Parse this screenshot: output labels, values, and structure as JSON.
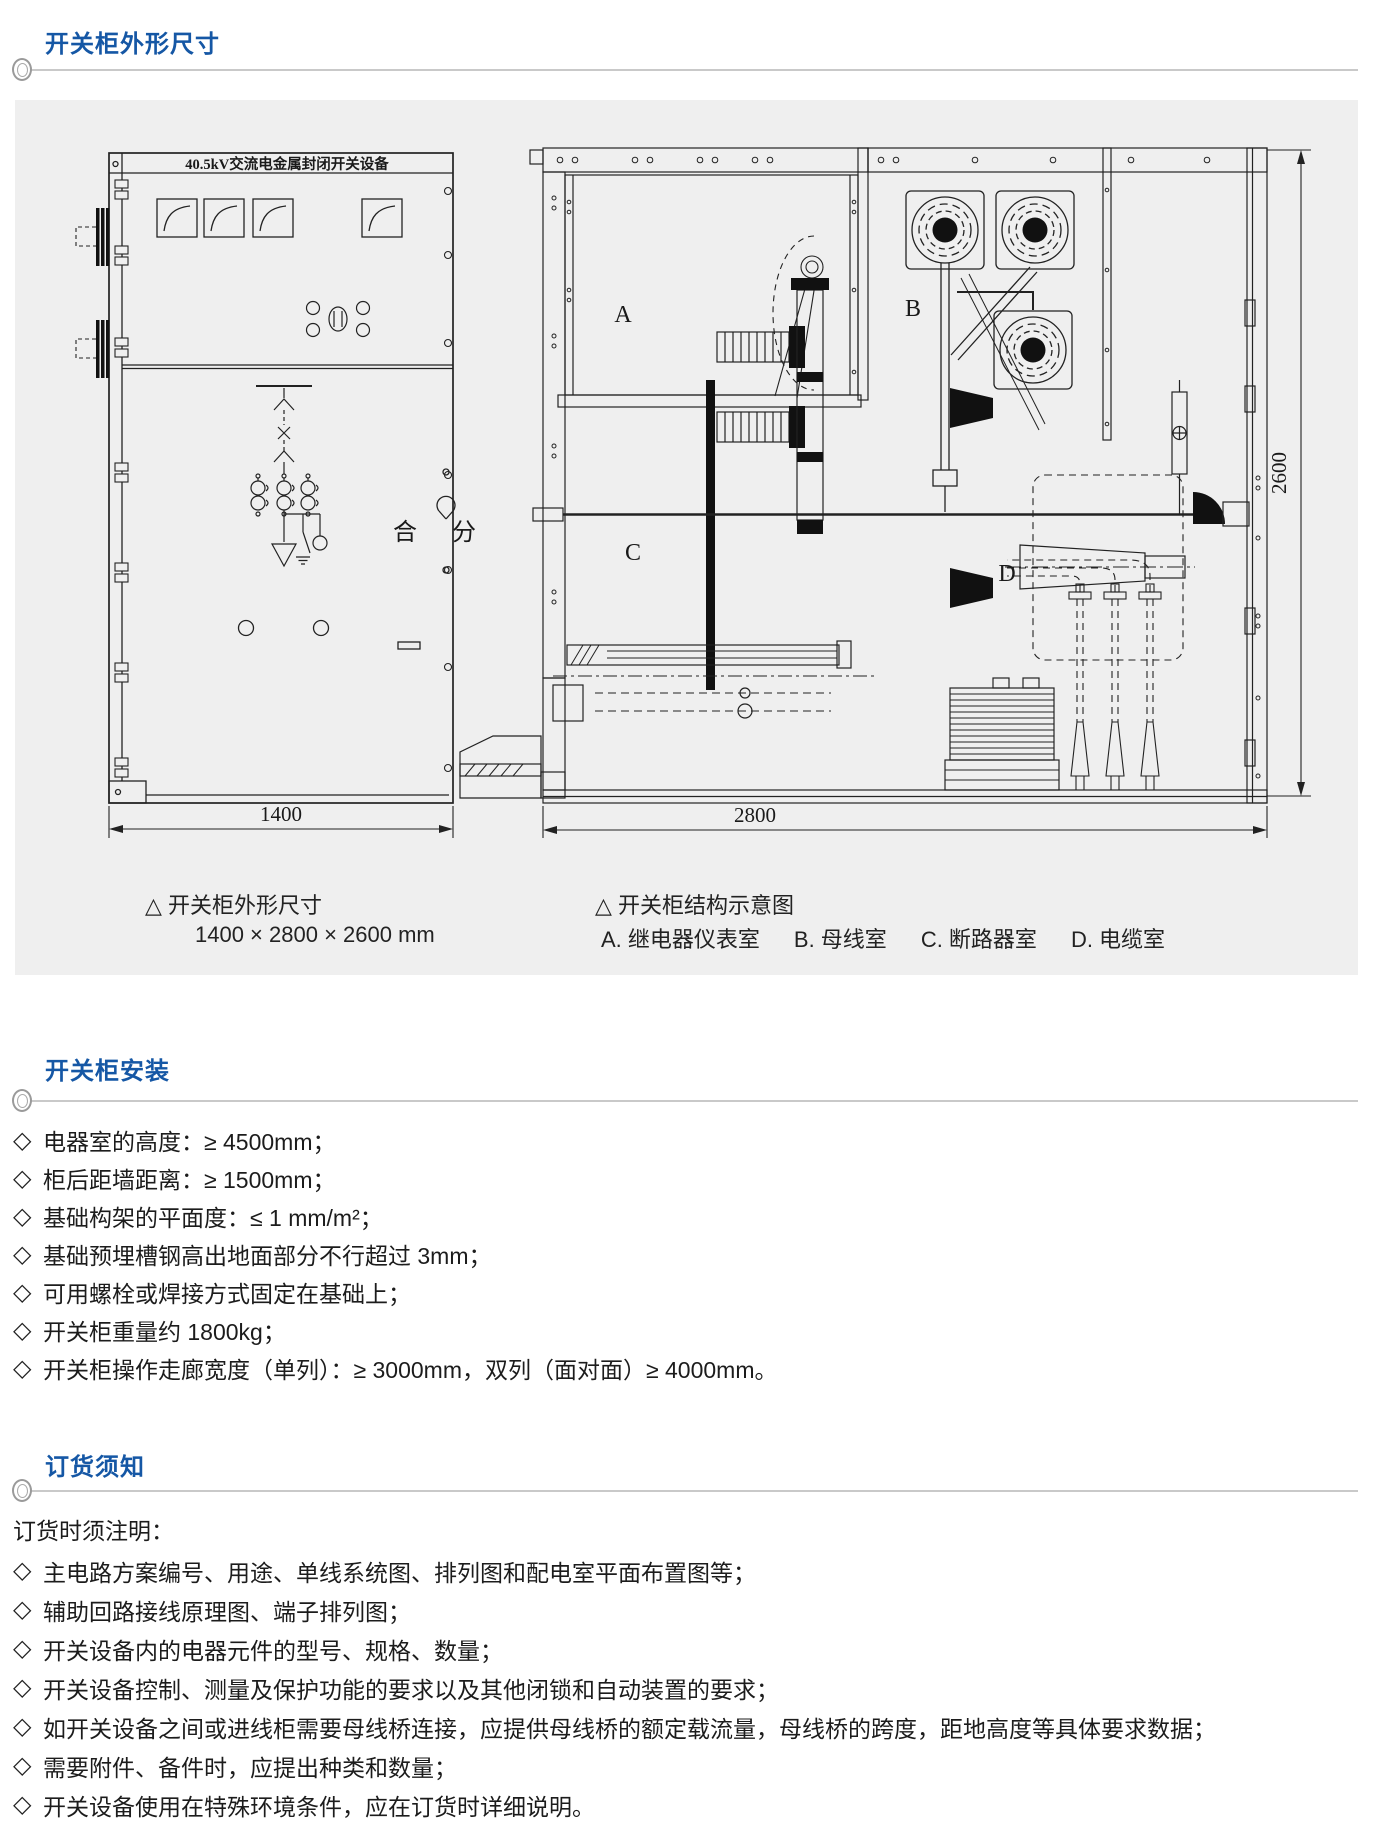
{
  "colors": {
    "accent": "#1557a5",
    "panel_bg": "#efefef",
    "header_line": "#c9c9c9",
    "ink": "#1c1c1c"
  },
  "bullet": "◇",
  "sections": {
    "dimensions": {
      "title": "开关柜外形尺寸"
    },
    "installation": {
      "title": "开关柜安装",
      "items": [
        "电器室的高度：≥ 4500mm；",
        "柜后距墙距离：≥ 1500mm；",
        "基础构架的平面度：≤ 1 mm/m²；",
        "基础预埋槽钢高出地面部分不行超过 3mm；",
        "可用螺栓或焊接方式固定在基础上；",
        "开关柜重量约 1800kg；",
        "开关柜操作走廊宽度（单列）：≥ 3000mm，双列（面对面）≥ 4000mm。"
      ]
    },
    "ordering": {
      "title": "订货须知",
      "intro": "订货时须注明：",
      "items": [
        "主电路方案编号、用途、单线系统图、排列图和配电室平面布置图等；",
        "辅助回路接线原理图、端子排列图；",
        "开关设备内的电器元件的型号、规格、数量；",
        "开关设备控制、测量及保护功能的要求以及其他闭锁和自动装置的要求；",
        "如开关设备之间或进线柜需要母线桥连接，应提供母线桥的额定载流量，母线桥的跨度，距地高度等具体要求数据；",
        "需要附件、备件时，应提出种类和数量；",
        "开关设备使用在特殊环境条件，应在订货时详细说明。"
      ]
    }
  },
  "diagram": {
    "cabinet_title": "40.5kV交流电金属封闭开关设备",
    "front_view": {
      "width_label": "1400",
      "close_label": "合",
      "open_label": "分"
    },
    "side_view": {
      "depth_label": "2800",
      "height_label": "2600",
      "compartments": [
        "A",
        "B",
        "C",
        "D"
      ]
    },
    "captions": {
      "left_title": "△ 开关柜外形尺寸",
      "left_sub": "1400 × 2800 × 2600 mm",
      "right_title": "△ 开关柜结构示意图",
      "legend": [
        "A. 继电器仪表室",
        "B. 母线室",
        "C. 断路器室",
        "D. 电缆室"
      ]
    }
  }
}
